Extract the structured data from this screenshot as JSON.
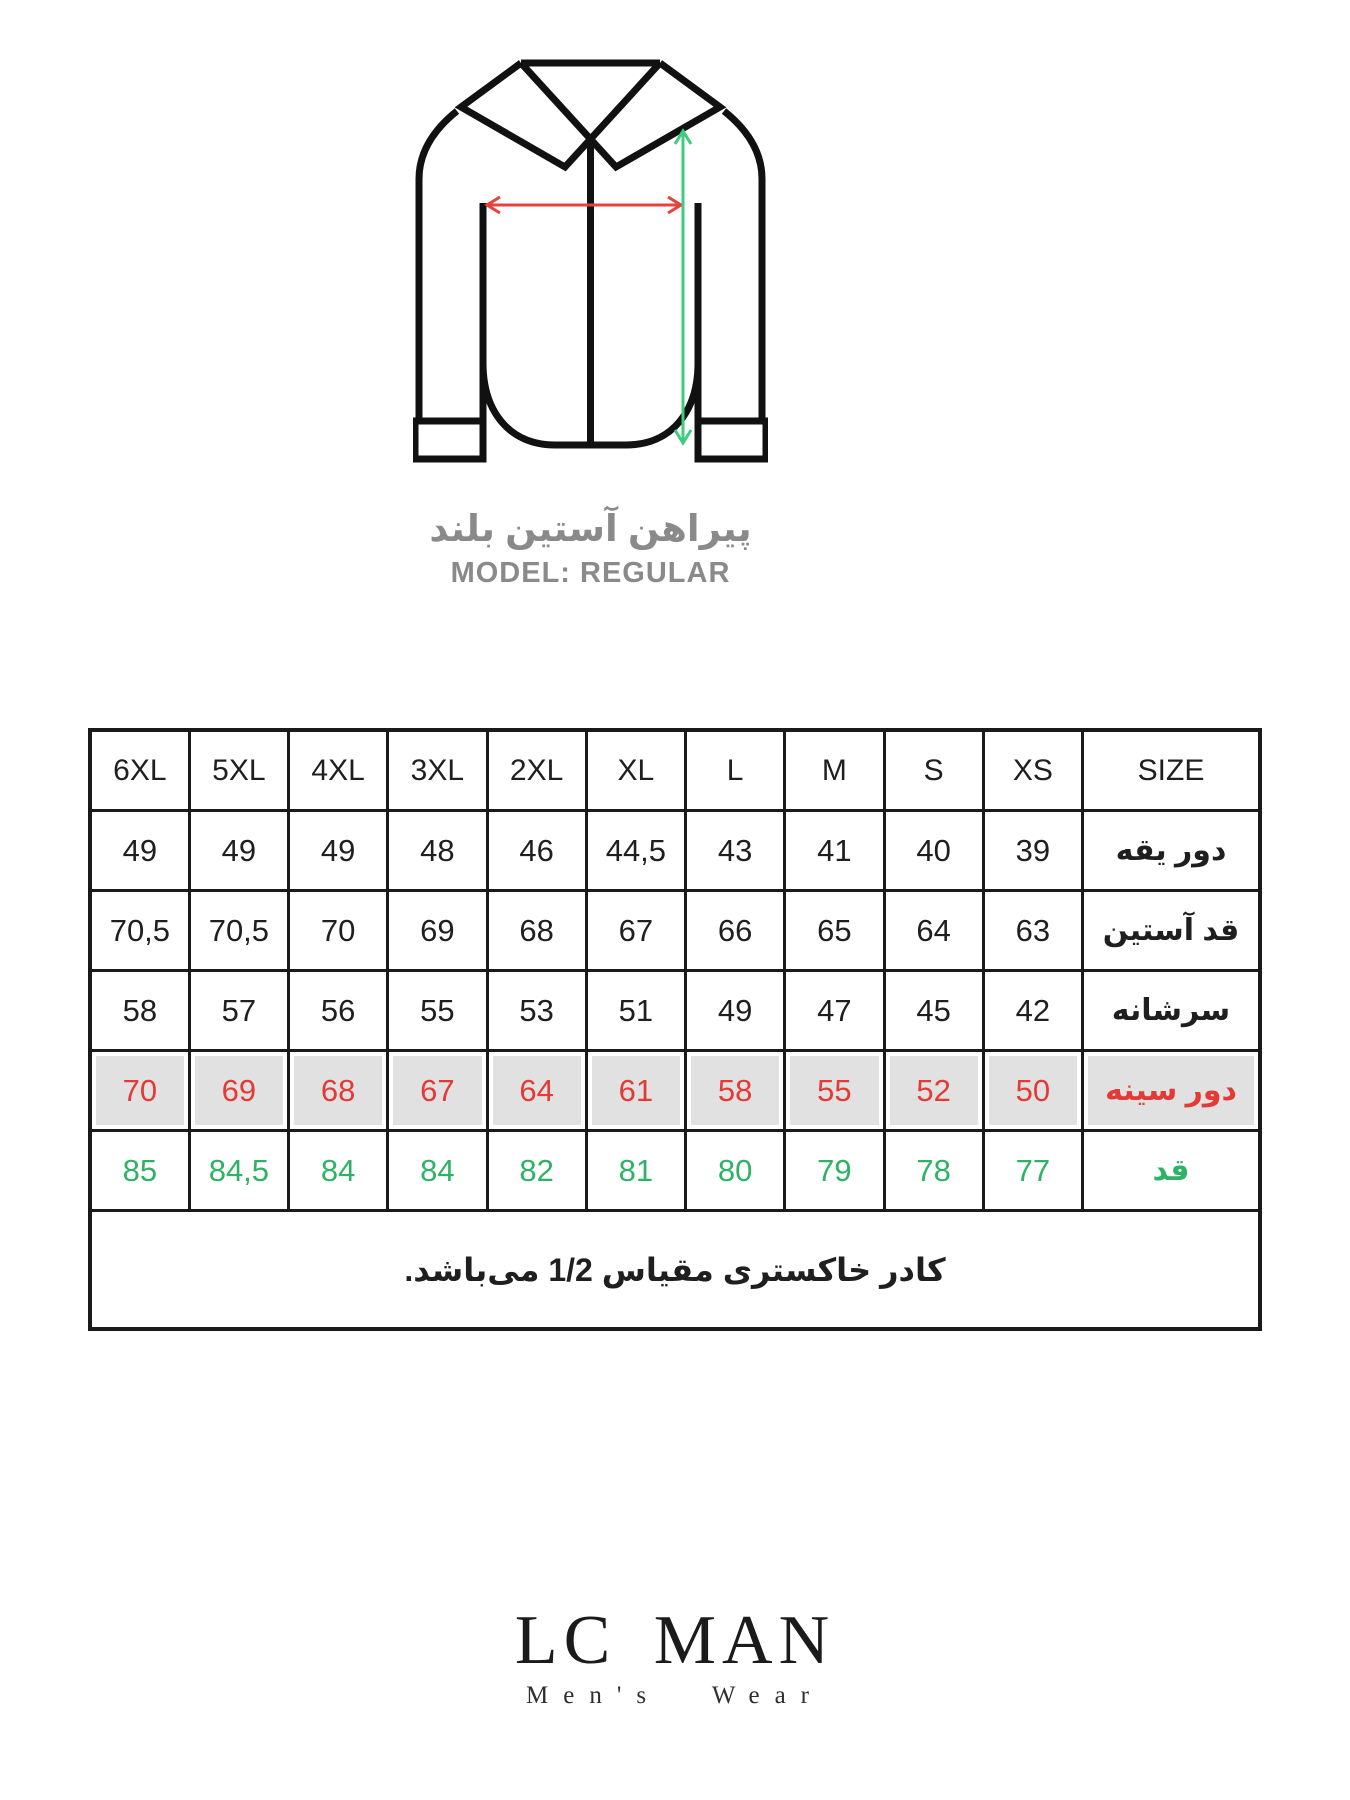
{
  "diagram": {
    "title_fa": "پیراهن آستین بلند",
    "model_label": "MODEL: REGULAR",
    "chest_arrow_color": "#e8413c",
    "length_arrow_color": "#3fcb80"
  },
  "table": {
    "header": [
      "6XL",
      "5XL",
      "4XL",
      "3XL",
      "2XL",
      "XL",
      "L",
      "M",
      "S",
      "XS",
      "SIZE"
    ],
    "rows": [
      {
        "label": "دور یقه",
        "values": [
          "49",
          "49",
          "49",
          "48",
          "46",
          "44,5",
          "43",
          "41",
          "40",
          "39"
        ]
      },
      {
        "label": "قد آستین",
        "values": [
          "70,5",
          "70,5",
          "70",
          "69",
          "68",
          "67",
          "66",
          "65",
          "64",
          "63"
        ]
      },
      {
        "label": "سرشانه",
        "values": [
          "58",
          "57",
          "56",
          "55",
          "53",
          "51",
          "49",
          "47",
          "45",
          "42"
        ]
      },
      {
        "label": "دور سینه",
        "values": [
          "70",
          "69",
          "68",
          "67",
          "64",
          "61",
          "58",
          "55",
          "52",
          "50"
        ]
      },
      {
        "label": "قد",
        "values": [
          "85",
          "84,5",
          "84",
          "84",
          "82",
          "81",
          "80",
          "79",
          "78",
          "77"
        ]
      }
    ],
    "note": "کادر خاکستری مقیاس 1/2 می‌باشد.",
    "chest_row_bg": "#e1e1e1",
    "chest_text_color": "#e53935",
    "height_text_color": "#2fb266"
  },
  "logo": {
    "name": "LC MAN",
    "tagline": "Men's Wear"
  }
}
